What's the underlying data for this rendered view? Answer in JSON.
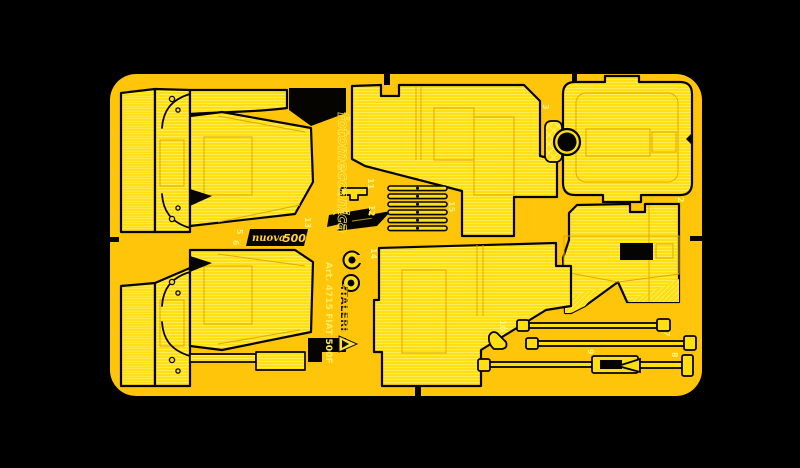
{
  "colors": {
    "bg": "#000000",
    "gold": "#FFC50A",
    "part": "#FFDE12",
    "etch": "#FFF06E",
    "line": "#E2A900",
    "black": "#060400",
    "badge_text": "#FFD43A",
    "logo_fill": "#FFE14D",
    "etch_text": "#FFEC5E"
  },
  "branding": {
    "fotomeccanica": "fotomeccanica",
    "italeri_wordmark": "ITALERI",
    "art_number": "Art. 4715 FIAT 500F",
    "nuova_badge_script": "nuova",
    "nuova_badge_number": "500",
    "fiat_badge": "FIAT"
  },
  "part_numbers": [
    {
      "label": "2"
    },
    {
      "label": "3"
    },
    {
      "label": "5"
    },
    {
      "label": "6"
    },
    {
      "label": "7"
    },
    {
      "label": "8"
    },
    {
      "label": "9"
    },
    {
      "label": "10"
    },
    {
      "label": "11"
    },
    {
      "label": "12"
    },
    {
      "label": "13"
    },
    {
      "label": "14"
    },
    {
      "label": "15"
    }
  ]
}
